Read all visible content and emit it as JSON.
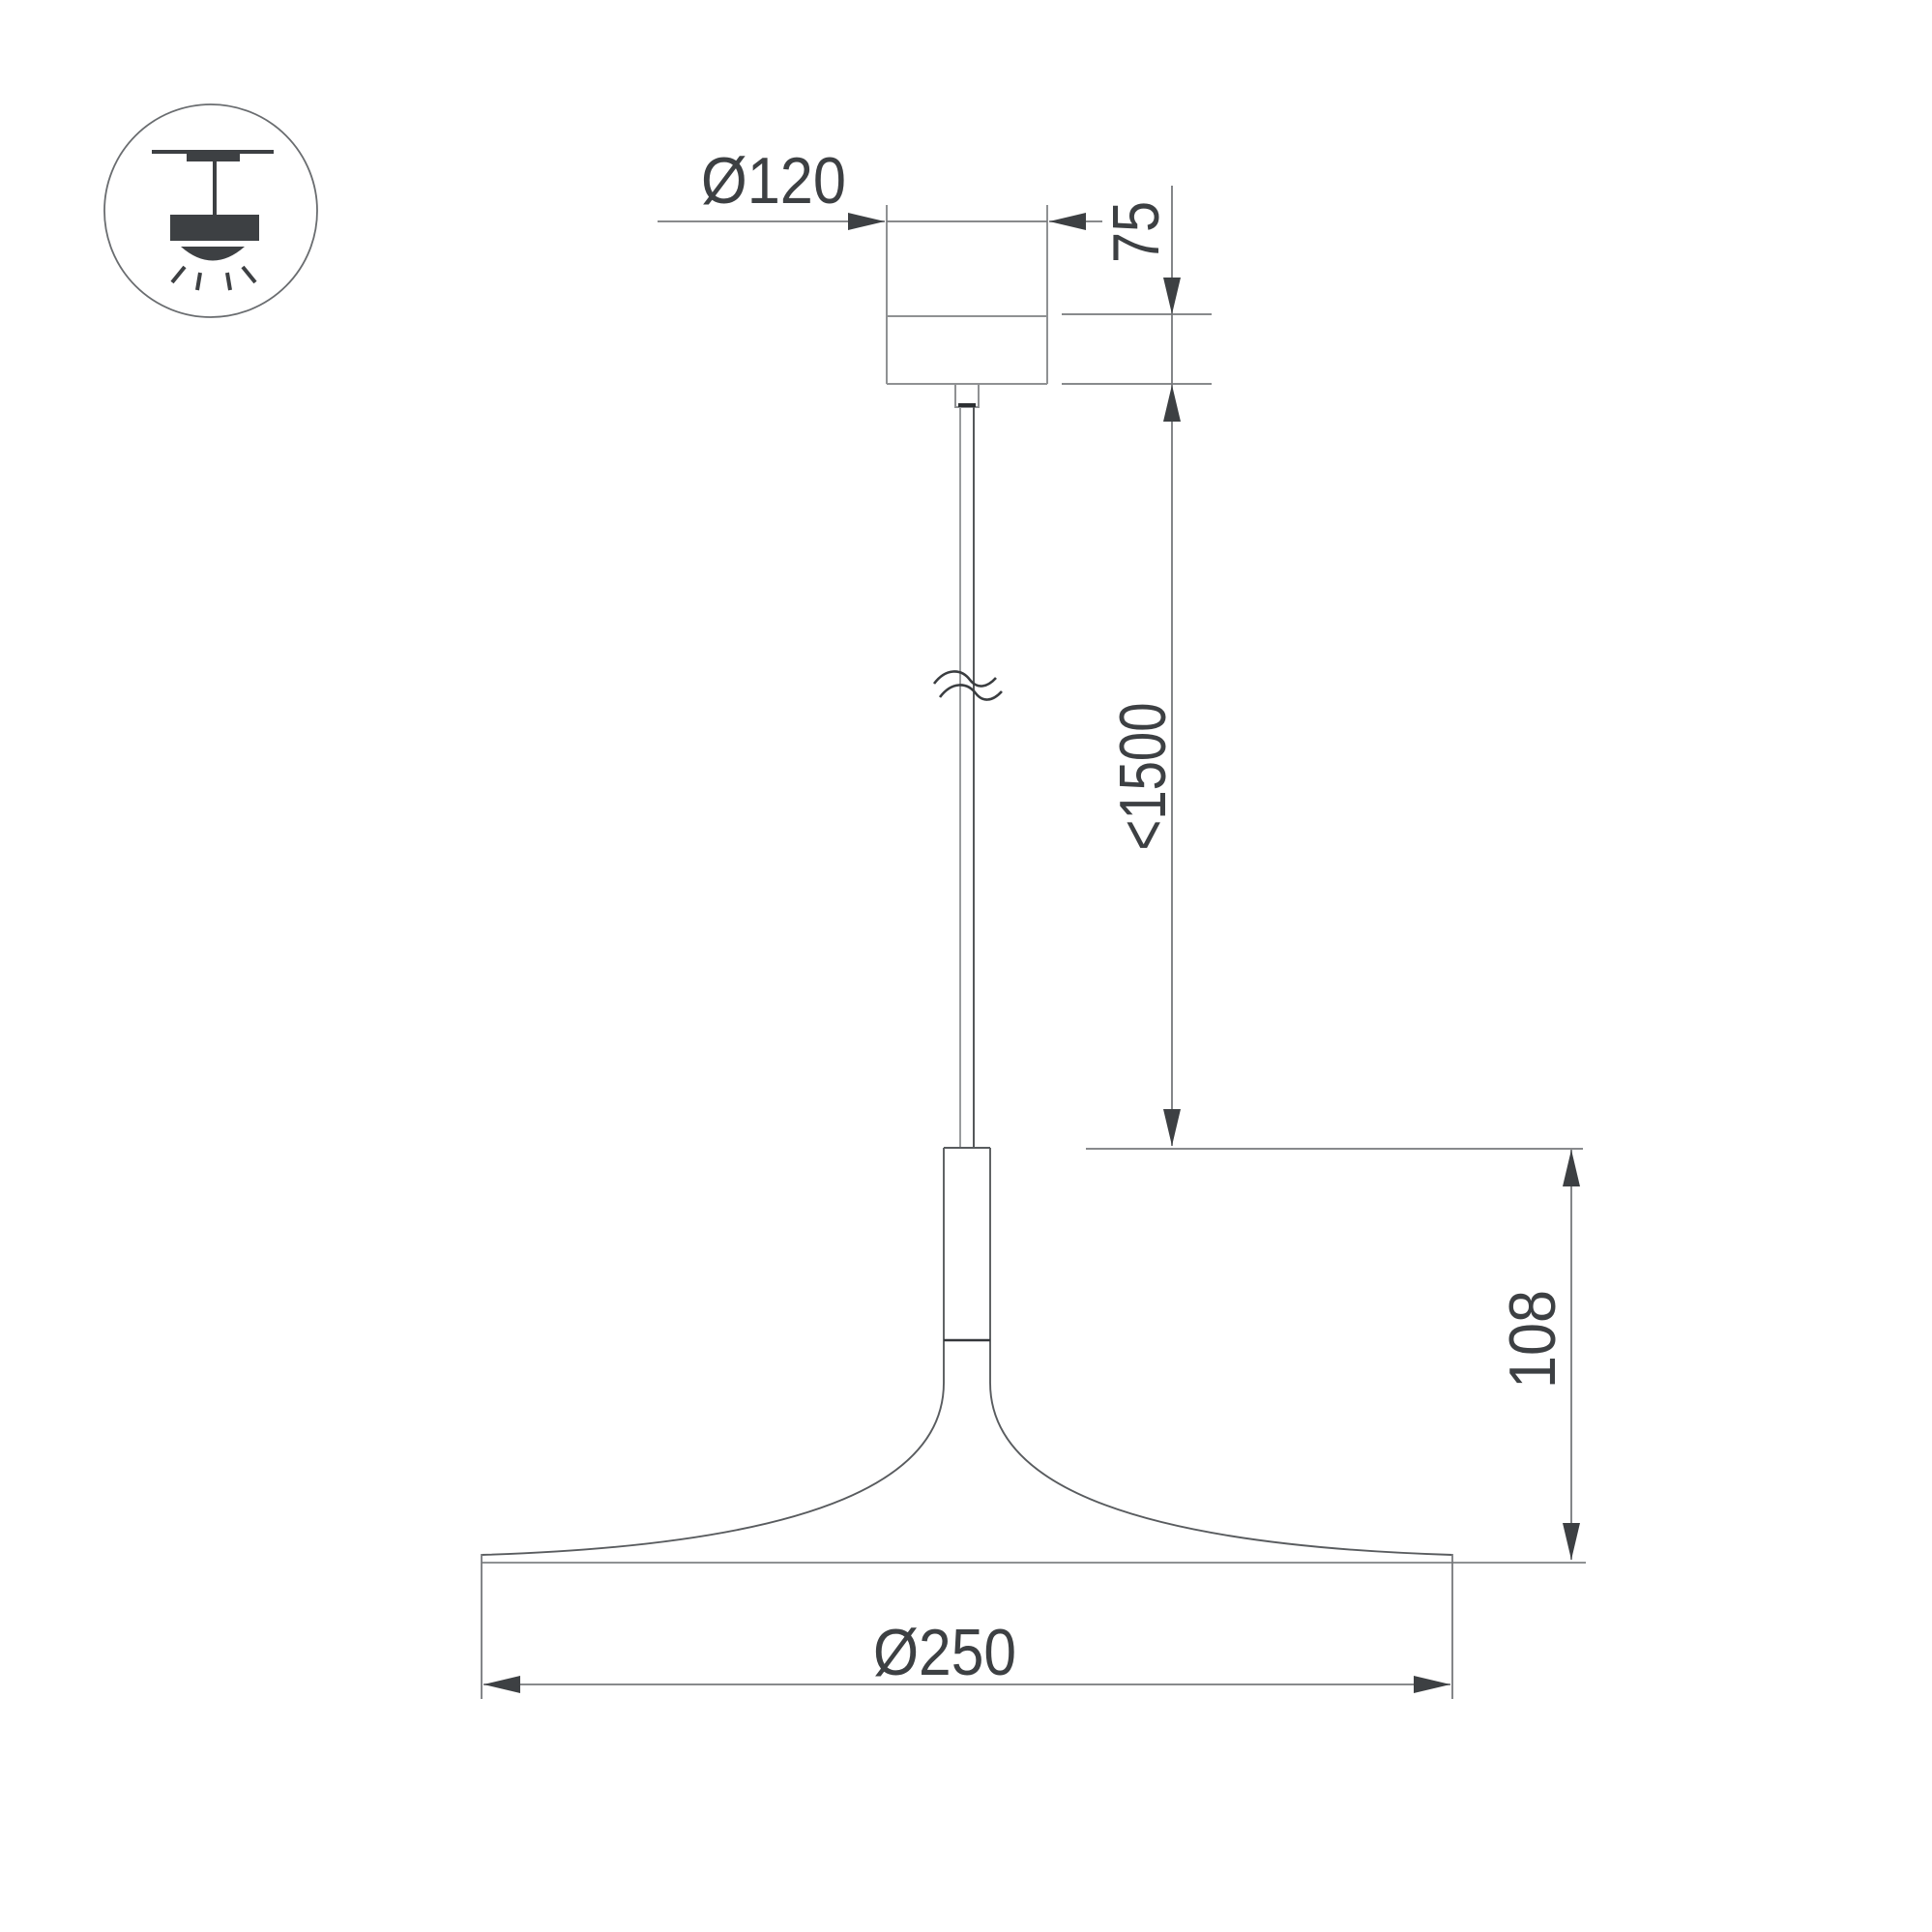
{
  "figure": {
    "kind": "technical dimension drawing",
    "background_color": "#ffffff",
    "line_color": "#8f9193",
    "dim_line_color": "#77797c",
    "text_color": "#3d4043"
  },
  "icon_legend": {
    "name": "pendant-ceiling-mount-icon"
  },
  "dimensions": {
    "canopy_diameter": {
      "label": "Ø120",
      "value": 120,
      "unit": "mm"
    },
    "canopy_height": {
      "label": "75",
      "value": 75,
      "unit": "mm"
    },
    "suspension_length": {
      "label": "<1500",
      "value": 1500,
      "unit": "mm"
    },
    "fixture_height": {
      "label": "108",
      "value": 108,
      "unit": "mm"
    },
    "shade_diameter": {
      "label": "Ø250",
      "value": 250,
      "unit": "mm"
    }
  }
}
